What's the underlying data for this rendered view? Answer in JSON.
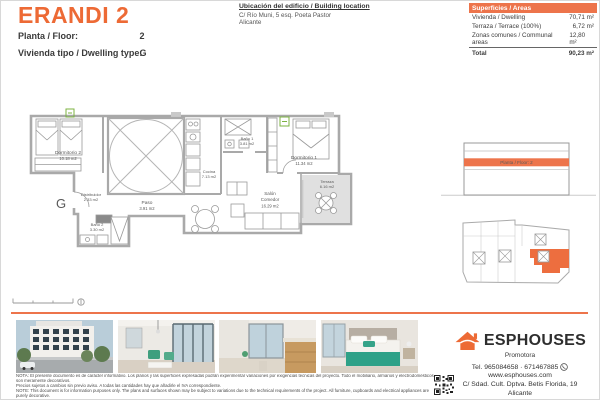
{
  "header": {
    "title": "ERANDI 2",
    "floor_label": "Planta / Floor:",
    "floor_value": "2",
    "type_label": "Vivienda tipo / Dwelling type:",
    "type_value": "G",
    "location_title": "Ubicación del edificio / Building location",
    "location_line1": "C/ Río Muni, 5 esq. Poeta Pastor",
    "location_line2": "Alicante"
  },
  "areas_table": {
    "header": "Superficies / Areas",
    "rows": [
      {
        "label": "Vivienda / Dwelling",
        "value": "70,71 m²"
      },
      {
        "label": "Terraza / Terrace (100%)",
        "value": "6,72 m²"
      },
      {
        "label": "Zonas comunes / Communal areas",
        "value": "12,80 m²"
      }
    ],
    "total_label": "Total",
    "total_value": "90,23 m²"
  },
  "floor_plan": {
    "unit_letter": "G",
    "rooms": [
      {
        "name": "Dormitorio 2",
        "area": "10.18 m2"
      },
      {
        "name": "Distribuidor",
        "area": "2.33 m2"
      },
      {
        "name": "Baño 2",
        "area": "3.30 m2"
      },
      {
        "name": "Paso",
        "area": "3.91 m2"
      },
      {
        "name": "Cocina",
        "area": "7.13 m2"
      },
      {
        "name": "Baño 1",
        "area": "3.81 m2"
      },
      {
        "name": "Dormitorio 1",
        "area": "11.34 m2"
      },
      {
        "name": "Salón Comedor",
        "line1": "Salón",
        "line2": "Comedor",
        "area": "16.29 m2"
      },
      {
        "name": "Terraza",
        "area": "6.16 m2"
      }
    ]
  },
  "elevation": {
    "band_label": "Planta / Floor: 2"
  },
  "footer": {
    "brand": "ESPHOUSES",
    "brand_sub": "Promotora",
    "tel": "Tel. 965084658 · 671467885",
    "web": "www.esphouses.com",
    "address1": "C/ Sdad. Cult. Dptva. Betis Florida, 19",
    "address2": "Alicante"
  },
  "disclaimer": {
    "line1": "NOTA: El presente documento es de carácter informativo. Los planos y las superficies expresadas podrán experimentar variaciones por exigencias técnicas del proyecto. Todo el mobiliario, armarios y electrodomésticos son meramente decorativos.",
    "line2": "Precios sujetos a cambios sin previo aviso. A todas las cantidades hay que añadirle el IVA correspondiente.",
    "line3": "NOTE: This document is for information purposes only. The plans and surfaces shown may be subject to variations due to the technical requirements of the project. All furniture, cupboards and electrical appliances are purely decorative.",
    "line4": "Prices subject to change without notice. VAT must be added to all amounts."
  },
  "icons": {
    "logo": "house-icon",
    "whatsapp": "whatsapp-phone-icon",
    "qr": "qr-code"
  },
  "colors": {
    "accent": "#ED6A35",
    "accent_fill": "#ED744B",
    "wall_gray": "#a9a9a9",
    "terrace_gray": "#e0e0e0",
    "marker_green": "#7cb342"
  }
}
